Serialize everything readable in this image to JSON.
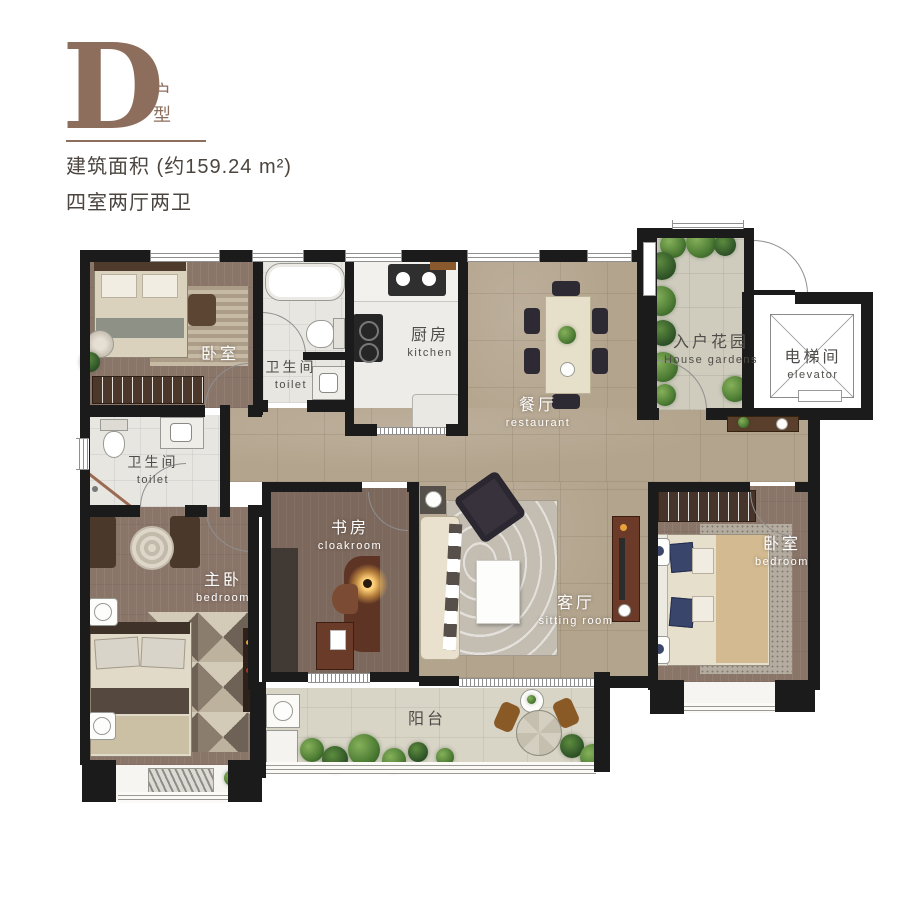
{
  "header": {
    "unit_letter": "D",
    "unit_suffix": "户型",
    "area_line": "建筑面积 (约159.24 m²)",
    "layout_line": "四室两厅两卫"
  },
  "rooms": {
    "bedroom_tl": {
      "zh": "卧室",
      "en": ""
    },
    "bath1": {
      "zh": "卫生间",
      "en": "toilet"
    },
    "kitchen": {
      "zh": "厨房",
      "en": "kitchen"
    },
    "dining": {
      "zh": "餐厅",
      "en": "restaurant"
    },
    "garden": {
      "zh": "入户花园",
      "en": "House gardens"
    },
    "elevator": {
      "zh": "电梯间",
      "en": "elevator"
    },
    "bath2": {
      "zh": "卫生间",
      "en": "toilet"
    },
    "master": {
      "zh": "主卧",
      "en": "bedroom"
    },
    "study": {
      "zh": "书房",
      "en": "cloakroom"
    },
    "living": {
      "zh": "客厅",
      "en": "sitting room"
    },
    "bedroom_r": {
      "zh": "卧室",
      "en": "bedroom"
    },
    "balcony": {
      "zh": "阳台",
      "en": ""
    }
  },
  "colors": {
    "accent_brown": "#8d6e5c",
    "wall_black": "#1b1b1b",
    "wood_floor": "#8a7569",
    "study_floor": "#7c685c",
    "tile_floor": "#b3a48d",
    "marble_floor": "#e7e6e1",
    "garden_floor": "#cfccbe",
    "balcony_floor": "#d8d4c6",
    "label_light": "#ffffff",
    "label_dark": "#4f4d49"
  }
}
